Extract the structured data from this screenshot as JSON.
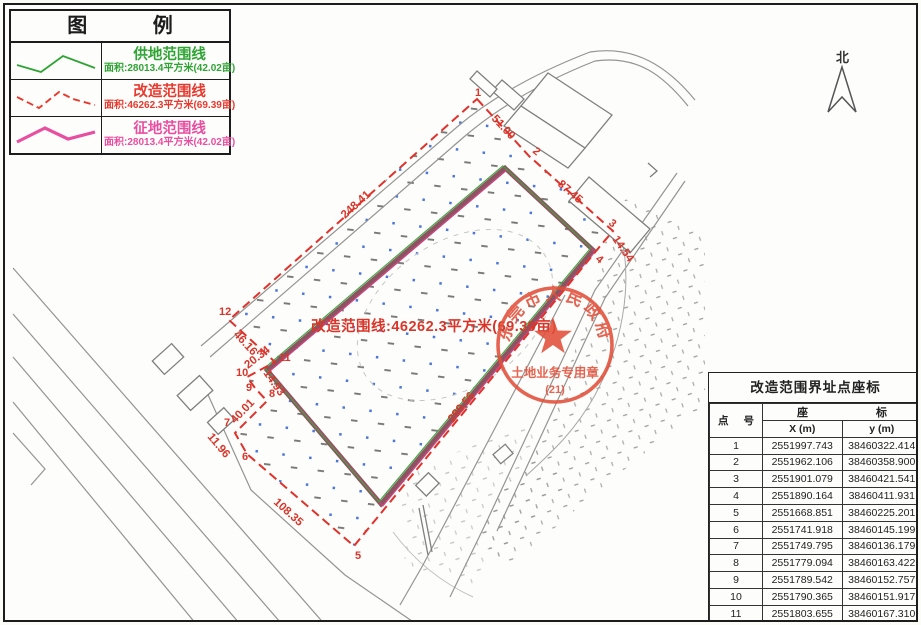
{
  "legend": {
    "title": "图 例",
    "items": [
      {
        "name": "供地范围线",
        "area": "面积:28013.4平方米(42.02亩)",
        "color": "#2fa435",
        "style": "solid"
      },
      {
        "name": "改造范围线",
        "area": "面积:46262.3平方米(69.39亩)",
        "color": "#e8392e",
        "style": "dashed"
      },
      {
        "name": "征地范围线",
        "area": "面积:28013.4平方米(42.02亩)",
        "color": "#e84fa0",
        "style": "thick-solid"
      }
    ]
  },
  "north": {
    "label": "北"
  },
  "map": {
    "annotation": "改造范围线:46262.3平方米(69.39亩)",
    "stamp": {
      "arc_text": "东莞市人民政府",
      "line1": "土地业务专用章",
      "line2": "(21)"
    },
    "point_labels": [
      "1",
      "2",
      "3",
      "4",
      "5",
      "6",
      "7",
      "8",
      "9",
      "10",
      "11",
      "12"
    ],
    "segment_labels": [
      {
        "text": "248.41"
      },
      {
        "text": "51.00"
      },
      {
        "text": "87.45"
      },
      {
        "text": "14.54"
      },
      {
        "text": "289.56"
      },
      {
        "text": "108.35"
      },
      {
        "text": "11.96"
      },
      {
        "text": "40.01"
      },
      {
        "text": "14.93"
      },
      {
        "text": "20.34"
      },
      {
        "text": "46.16"
      }
    ]
  },
  "table": {
    "title": "改造范围界址点座标",
    "col_point": "点 号",
    "header_coord_left": "座",
    "header_coord_right": "标",
    "col_x": "X (m)",
    "col_y": "y (m)",
    "rows": [
      {
        "n": "1",
        "x": "2551997.743",
        "y": "38460322.414"
      },
      {
        "n": "2",
        "x": "2551962.106",
        "y": "38460358.900"
      },
      {
        "n": "3",
        "x": "2551901.079",
        "y": "38460421.541"
      },
      {
        "n": "4",
        "x": "2551890.164",
        "y": "38460411.931"
      },
      {
        "n": "5",
        "x": "2551668.851",
        "y": "38460225.201"
      },
      {
        "n": "6",
        "x": "2551741.918",
        "y": "38460145.199"
      },
      {
        "n": "7",
        "x": "2551749.795",
        "y": "38460136.179"
      },
      {
        "n": "8",
        "x": "2551779.094",
        "y": "38460163.422"
      },
      {
        "n": "9",
        "x": "2551789.542",
        "y": "38460152.757"
      },
      {
        "n": "10",
        "x": "2551790.365",
        "y": "38460151.917"
      },
      {
        "n": "11",
        "x": "2551803.655",
        "y": "38460167.310"
      },
      {
        "n": "12",
        "x": "2551835.730",
        "y": "38460134.111"
      }
    ]
  }
}
